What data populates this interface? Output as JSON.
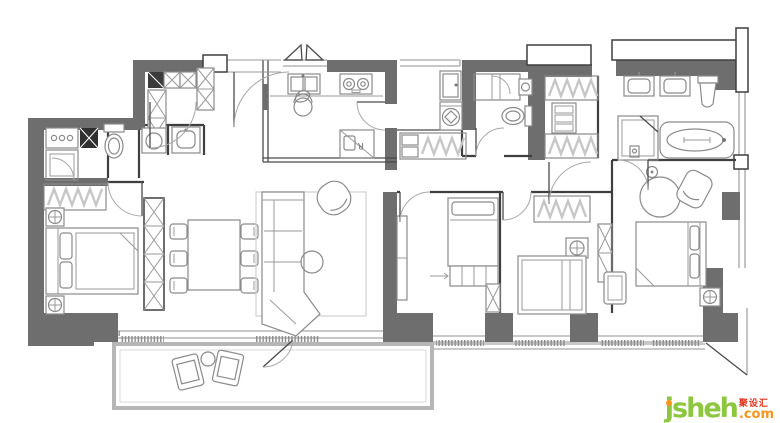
{
  "watermark": {
    "brand": "jsheh",
    "suffix": ".com",
    "cjk": "聚设汇"
  },
  "labels": {
    "fridge_glyph": "R"
  },
  "colors": {
    "background": "#ffffff",
    "wall": "#6e6e6e",
    "wall_light": "#b6b6b6",
    "line_dark": "#3f3f3f",
    "fixture": "#8a8a8a",
    "soft": "#c6c6c6",
    "brand_green": "#8dc63f",
    "brand_orange": "#f7941d",
    "brand_red": "#e0341b"
  },
  "plan": {
    "rooms": [
      "entry",
      "entry-closet",
      "kitchen",
      "living-room",
      "dining-area",
      "hallway",
      "laundry",
      "bathroom-1",
      "bathroom-2",
      "walk-in-closet",
      "master-bathroom",
      "bedroom-1",
      "bedroom-2",
      "bedroom-3",
      "master-bedroom",
      "balcony"
    ],
    "furniture": [
      "double-bed",
      "single-bed",
      "wardrobe",
      "sofa",
      "armchair",
      "coffee-table",
      "rug",
      "dining-table",
      "dining-chairs",
      "tv-desk",
      "nightstand",
      "kitchen-sink",
      "cooktop",
      "refrigerator",
      "bar-stool",
      "washing-machine",
      "water-heater",
      "shower",
      "toilet",
      "wash-basin",
      "bathtub",
      "vanity",
      "balcony-chairs",
      "balcony-table"
    ]
  }
}
